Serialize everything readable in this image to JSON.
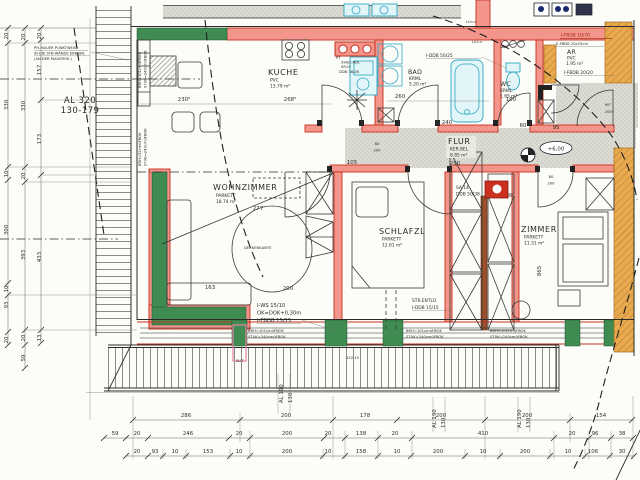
{
  "drawing": {
    "type": "floor-plan",
    "language": "de",
    "elevation_marker": "+6,00"
  },
  "rooms": {
    "kuche": {
      "name": "KUCHE",
      "floor": "PVC",
      "area": "13.79 m²"
    },
    "bad": {
      "name": "BAD",
      "floor": "KRML",
      "area": "5.20 m²"
    },
    "wc": {
      "name": "WC",
      "floor": "KRML",
      "area": "1.65 m²"
    },
    "ar": {
      "name": "AR",
      "floor": "PVC",
      "area": "1.95 m²"
    },
    "flur": {
      "name": "FLUR",
      "floor": "KER.BEL",
      "area": "8.85 m²"
    },
    "wohnzimmer": {
      "name": "WOHNZIMMER",
      "floor": "PARKETT",
      "area": "18.74 m²"
    },
    "schlafzimmer": {
      "name": "SCHLAFZL",
      "floor": "PARKETT",
      "area": "12.61 m²"
    },
    "zimmer": {
      "name": "ZIMMER",
      "floor": "PARKETT",
      "area": "11.31 m²"
    }
  },
  "annotations": {
    "deckenkante": "DECKENKANTE",
    "ph_mauer_1": "PH-MAUER PUNKTWEISE",
    "ph_mauer_2": "IN DIE STB-WÄNDE EINBDN.",
    "ph_mauer_3": "(AN DER MAUEROK.)",
    "al320_1": "AL 320",
    "al320_2": "130-179",
    "al190": "AL 190",
    "al190_b": "130",
    "iws_1": "I-WS 15/10",
    "iws_2": "OK=DOK+0,30m",
    "iws_3": "I-FBDB 15/15",
    "brh101_1": "BRH=101cmüFBOK",
    "brh101_2": "STUK=240cmüFBOK",
    "brh52_1": "BRH=52cmüFBOK",
    "brh52_2": "STUK=240cmüFBOK",
    "str_entl_1": "STR.ENTLÜ.",
    "str_entl_2": "I-DDB 15/15",
    "iddb5025": "I-DDB 50/25",
    "ifbdb1070": "I-FBDB 10/70",
    "efbdb2025": "E-FBDB 20x25cm",
    "ifbdb2020": "I-FBDB 20/20",
    "sa14_1": "SA 14",
    "sa14_2": "DDB 50/38",
    "pt_1": "PT",
    "pt_2": "9x6/C-BDL",
    "pt_3": "SR15",
    "pt_4": "DDB 38/26",
    "lu": "LU>>",
    "elevation": "+6,00",
    "slit": "SLIT",
    "door_80": "80",
    "door_200": "200",
    "door_90": "90°",
    "door_200e": "200!"
  },
  "interior_dims": {
    "k1": "230⁵",
    "k2": "268⁵",
    "b1": "260",
    "b2": "240",
    "wc1": "100",
    "f1": "105",
    "f2": "290",
    "f3": "60",
    "f4": "95",
    "w1": "277",
    "w2": "163",
    "w3": "200",
    "z1": "865",
    "misc1": "152 15"
  },
  "dims": {
    "bottom_row1": [
      "286",
      "200",
      "178",
      "200",
      "200",
      "154"
    ],
    "bottom_row2": [
      "59",
      "20",
      "246",
      "20",
      "200",
      "20",
      "138",
      "20",
      "410",
      "20",
      "96",
      "38"
    ],
    "bottom_row3": [
      "20",
      "93",
      "10",
      "153",
      "10",
      "200",
      "10",
      "158",
      "10",
      "200",
      "10",
      "200",
      "10",
      "106",
      "30"
    ],
    "left_col1": [
      "20",
      "330",
      "10",
      "300",
      "10",
      "93",
      "20"
    ],
    "left_col2": [
      "20",
      "330",
      "20",
      "393",
      "20",
      "59"
    ],
    "left_col3": [
      "20",
      "157",
      "173",
      "433",
      "13"
    ]
  },
  "colors": {
    "wall_accent_red": "#c9301e",
    "wall_fill_salmon": "#f3958a",
    "insulation_green": "#3f8b51",
    "existing_orange": "#e9a94f",
    "fixture_cyan": "#8fd9e6",
    "floor_gray": "#dddcd4",
    "paper": "#fcfcf9"
  }
}
